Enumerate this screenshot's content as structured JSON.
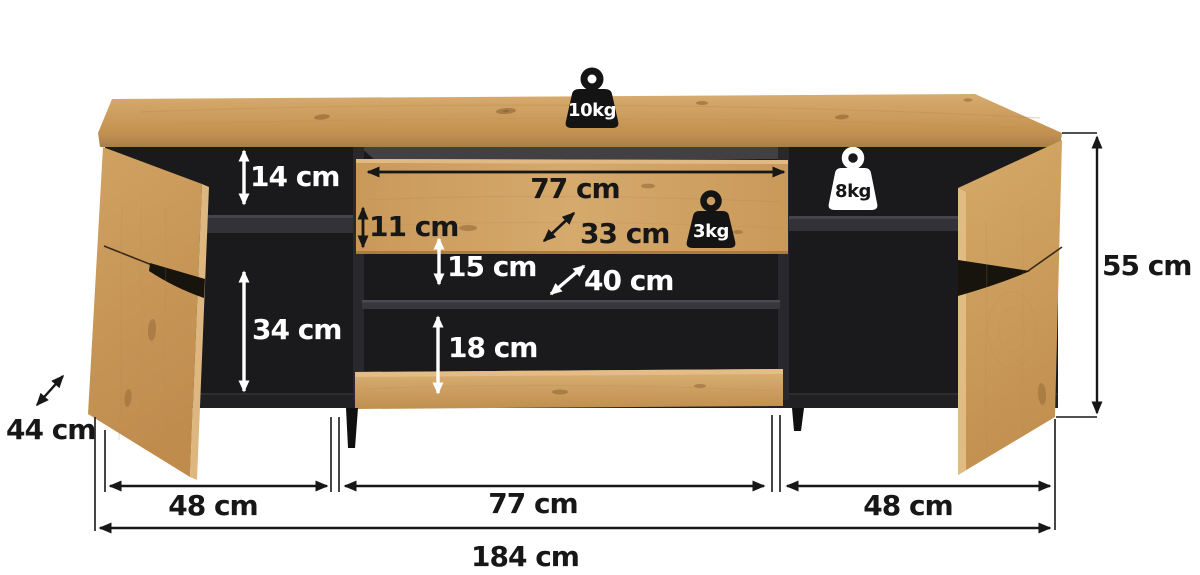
{
  "title": "TV stand dimension diagram",
  "colors": {
    "background": "#ffffff",
    "wood": "#c99a5f",
    "wood_light": "#dab177",
    "wood_dark": "#b4834a",
    "interior_black": "#1a1a1c",
    "shelf_gray": "#323237",
    "dimension_line": "#171717",
    "dimension_text_dark": "#171717",
    "dimension_text_light": "#ffffff",
    "weight_badge_dark": "#141414",
    "weight_badge_light": "#ffffff"
  },
  "weights": {
    "top_load": "10kg",
    "drawer_load": "3kg",
    "shelf_load": "8kg"
  },
  "dimensions": {
    "top_gap": "14 cm",
    "drawer_front_height": "11 cm",
    "drawer_width": "77 cm",
    "inner_depth_upper": "33 cm",
    "center_gap": "15 cm",
    "inner_depth_lower": "40 cm",
    "left_compartment_height": "34 cm",
    "bottom_compartment_height": "18 cm",
    "depth": "44 cm",
    "height": "55 cm",
    "left_section_width": "48 cm",
    "center_section_width": "77 cm",
    "right_section_width": "48 cm",
    "total_width": "184 cm"
  }
}
